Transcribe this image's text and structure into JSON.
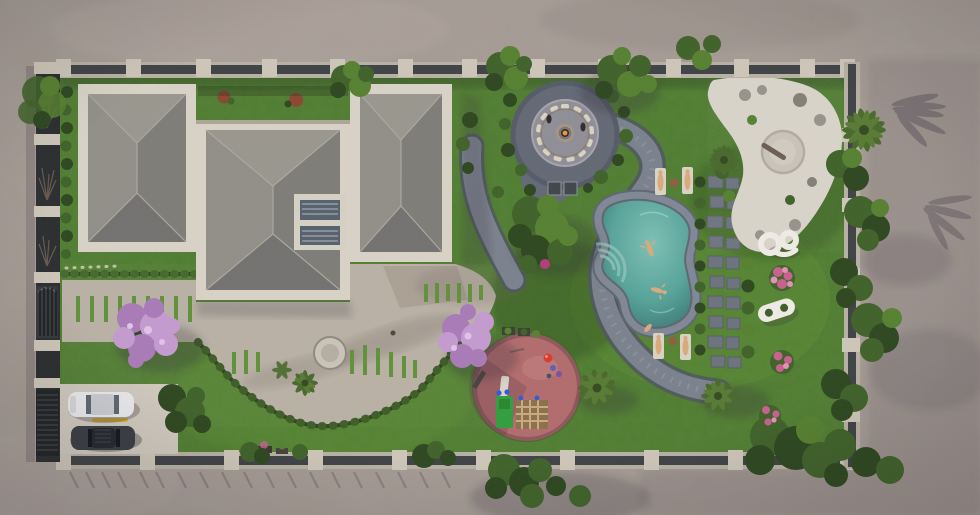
{
  "meta": {
    "title": "Aerial 3D landscape render of a walled villa plot",
    "view": "top-down",
    "canvas": {
      "width": 980,
      "height": 515
    }
  },
  "palette": {
    "ground": "#a49a93",
    "ground_shadow": "#6e6368",
    "wall_pillar": "#cdc6b8",
    "wall_panel": "#3e4144",
    "wall_base": "#b7b0a3",
    "fence_dark": "#292c2e",
    "parapet": "#d8d3c6",
    "roof_n": "#99968e",
    "roof_e": "#7e7c76",
    "roof_s": "#737170",
    "roof_w": "#908e86",
    "roof_mid": "#8b8984",
    "skylight_frame": "#d6d1c5",
    "skylight_glass": "#55606c",
    "lawn": "#4d7b2e",
    "lawn_light": "#5f9138",
    "lawn_dark": "#365c21",
    "patio": "#b9b1a4",
    "patio_light": "#c9c2b5",
    "path": "#79818d",
    "path_dark": "#4e5560",
    "plaza": "#626874",
    "plaza_inner": "#8f8d96",
    "seat_cream": "#d9d3c4",
    "fire_orange": "#ef9338",
    "pool_water": "#4a968e",
    "pool_water_light": "#7cc0b4",
    "pool_coping": "#7e8794",
    "stone": "#6b727c",
    "sand": "#dad5cb",
    "pad": "#c9c3b8",
    "rock": "#97928a",
    "sculpture": "#efece5",
    "playground": "#b26b6c",
    "playground_dark": "#8d575b",
    "equip_green": "#2f9e3c",
    "equip_tan": "#b99a6e",
    "ball_red": "#d93a2f",
    "equip_blue": "#2b5bd7",
    "tree_dark": "#2c461e",
    "tree_mid": "#3e6128",
    "tree_light": "#55802f",
    "palm": "#48682b",
    "jacaranda": "#a87ab8",
    "jacaranda_light": "#c49ad0",
    "pink_flower": "#c75f8d",
    "red_shrub": "#8a4530",
    "car_white": "#e9e9ec",
    "car_dark": "#383c42",
    "drive": "#cfc9bd",
    "stripe_yellow": "#d8b23a",
    "skin": "#d9a97c",
    "table_brown": "#8a5f3e",
    "branch": "#6b5d52"
  },
  "scene": {
    "description": "Walled rectangular villa plot seen from directly above: flat-gray hip-roofed house with two skylights on the left; entry walkway and stone patio with inlaid grass strips to the south; circular sunken fire-pit lounge ringed by cream seats to the north-east; serpentine cobble path; free-form turquoise pool with two swimmers and four sun loungers; stepping-stone path lined with clipped shrubs; white gravel zen corner with round pad, rocks and palms; circular rose-coloured playground with green slide tower and climbing frame; jacaranda trees in bloom; driveway with a white car and a dark car behind slatted gates; mottled grey pavement with long palm shadows outside the walls.",
    "counts": {
      "fire_pit_seats": 13,
      "pool_swimmers": 2,
      "sun_loungers": 4,
      "lounger_tables": 2,
      "cars": 2,
      "skylights": 2,
      "garden_sculptures": 2,
      "jacaranda_trees": 2,
      "gates": 2
    }
  }
}
